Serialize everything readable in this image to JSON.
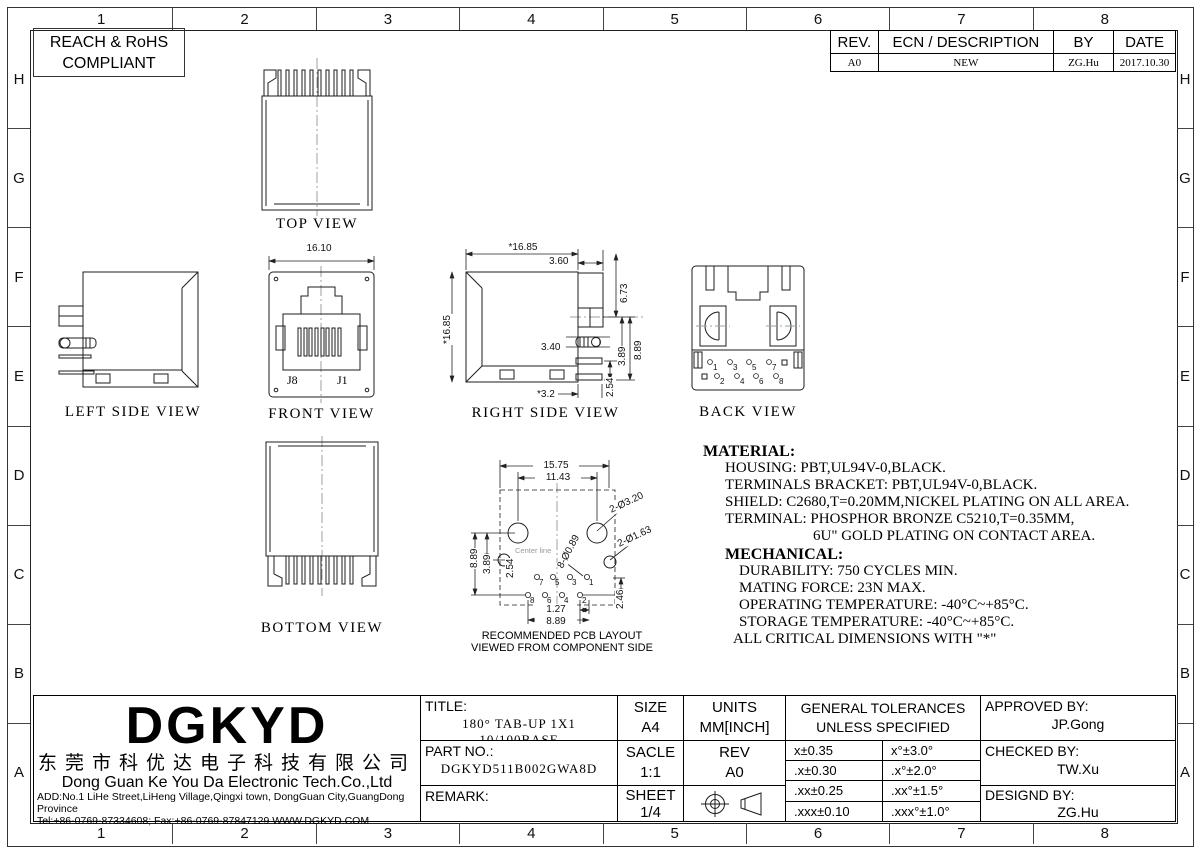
{
  "compliance": {
    "line1": "REACH & RoHS",
    "line2": "COMPLIANT"
  },
  "zones": {
    "cols": [
      "1",
      "2",
      "3",
      "4",
      "5",
      "6",
      "7",
      "8"
    ],
    "rows": [
      "H",
      "G",
      "F",
      "E",
      "D",
      "C",
      "B",
      "A"
    ]
  },
  "revision_table": {
    "headers": [
      "REV.",
      "ECN / DESCRIPTION",
      "BY",
      "DATE"
    ],
    "row": [
      "A0",
      "NEW",
      "ZG.Hu",
      "2017.10.30"
    ]
  },
  "views": {
    "top": {
      "label": "TOP VIEW"
    },
    "left_side": {
      "label": "LEFT SIDE VIEW"
    },
    "front": {
      "label": "FRONT VIEW",
      "dim_width": "16.10",
      "pin_left": "J8",
      "pin_right": "J1"
    },
    "right_side": {
      "label": "RIGHT SIDE VIEW",
      "dims": {
        "width": "*16.85",
        "tab": "3.60",
        "height": "*16.85",
        "d673": "6.73",
        "d889": "8.89",
        "d389": "3.89",
        "d254": "2.54",
        "d340": "3.40",
        "d32": "*3.2"
      }
    },
    "back": {
      "label": "BACK VIEW",
      "pins_odd": [
        "1",
        "3",
        "5",
        "7"
      ],
      "pins_even": [
        "2",
        "4",
        "6",
        "8"
      ]
    },
    "bottom": {
      "label": "BOTTOM VIEW"
    },
    "pcb": {
      "caption1": "RECOMMENDED PCB LAYOUT",
      "caption2": "VIEWED FROM COMPONENT SIDE",
      "centerline": "Center line",
      "dims": {
        "w1575": "15.75",
        "w1143": "11.43",
        "holes320": "2-Ø3.20",
        "holes163": "2-Ø1.63",
        "holes089": "8-Ø0.89",
        "d889l": "8.89",
        "d389": "3.89",
        "d254": "2.54",
        "d246": "2.46",
        "d127": "1.27",
        "d889b": "8.89"
      },
      "pins_odd": [
        "7",
        "5",
        "3",
        "1"
      ],
      "pins_even": [
        "8",
        "6",
        "4",
        "2"
      ]
    }
  },
  "notes": {
    "material": {
      "heading": "MATERIAL:",
      "lines": [
        "HOUSING: PBT,UL94V-0,BLACK.",
        "TERMINALS BRACKET: PBT,UL94V-0,BLACK.",
        "SHIELD: C2680,T=0.20MM,NICKEL PLATING ON ALL AREA.",
        "TERMINAL: PHOSPHOR BRONZE C5210,T=0.35MM,",
        "6U\" GOLD PLATING ON CONTACT AREA."
      ]
    },
    "mechanical": {
      "heading": "MECHANICAL:",
      "lines": [
        "DURABILITY: 750 CYCLES MIN.",
        "MATING FORCE: 23N MAX.",
        "OPERATING TEMPERATURE: -40°C~+85°C.",
        "STORAGE TEMPERATURE: -40°C~+85°C.",
        "ALL CRITICAL DIMENSIONS WITH \"*\""
      ]
    }
  },
  "title_block": {
    "logo": "DGKYD",
    "company_cn": "东莞市科优达电子科技有限公司",
    "company_en": "Dong Guan Ke You Da Electronic Tech.Co.,Ltd",
    "address": "ADD:No.1 LiHe Street,LiHeng Village,Qingxi town, DongGuan City,GuangDong Province",
    "contact": "Tel:+86-0769-87334608; Fax:+86-0769-87847129  WWW.DGKYD.COM",
    "title_label": "TITLE:",
    "title_value": "180°  TAB-UP  1X1  10/100BASE",
    "part_no_label": "PART NO.:",
    "part_no_value": "DGKYD511B002GWA8D",
    "remark_label": "REMARK:",
    "size_label": "SIZE",
    "size_value": "A4",
    "units_label": "UNITS",
    "units_value": "MM[INCH]",
    "scale_label": "SACLE",
    "scale_value": "1:1",
    "rev_label": "REV",
    "rev_value": "A0",
    "sheet_label": "SHEET",
    "sheet_value": "1/4",
    "tolerances": {
      "header1": "GENERAL TOLERANCES",
      "header2": "UNLESS SPECIFIED",
      "rows": [
        [
          "x±0.35",
          "x°±3.0°"
        ],
        [
          ".x±0.30",
          ".x°±2.0°"
        ],
        [
          ".xx±0.25",
          ".xx°±1.5°"
        ],
        [
          ".xxx±0.10",
          ".xxx°±1.0°"
        ]
      ]
    },
    "approved_label": "APPROVED BY:",
    "approved_value": "JP.Gong",
    "checked_label": "CHECKED BY:",
    "checked_value": "TW.Xu",
    "designed_label": "DESIGND BY:",
    "designed_value": "ZG.Hu"
  }
}
